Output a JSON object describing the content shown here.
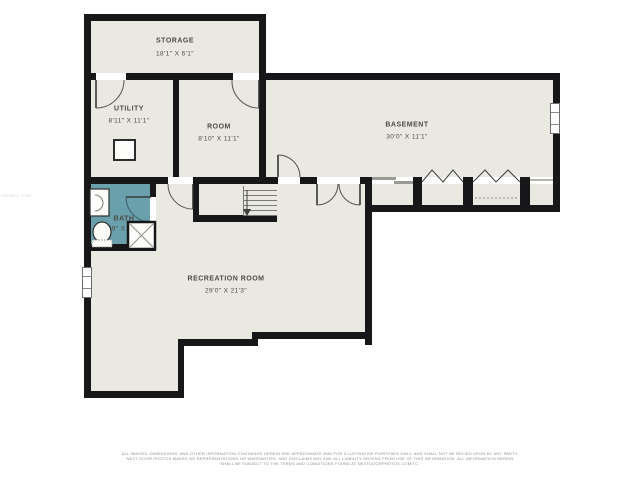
{
  "plan": {
    "title": "Basement floor plan",
    "rooms": [
      {
        "name": "STORAGE",
        "dims": "18'1\" X 6'1\""
      },
      {
        "name": "UTILITY",
        "dims": "8'11\" X 11'1\""
      },
      {
        "name": "ROOM",
        "dims": "8'10\" X 11'1\""
      },
      {
        "name": "BASEMENT",
        "dims": "30'0\" X 11'1\""
      },
      {
        "name": "BATH",
        "dims": "6'9\" X 5'2\""
      },
      {
        "name": "RECREATION ROOM",
        "dims": "29'0\" X 21'3\""
      }
    ],
    "colors": {
      "background": "#ffffff",
      "floor": "#e9e8e1",
      "wall": "#17171a",
      "bath_fill": "#6aa0ac",
      "label_text": "#4c4b45"
    },
    "symbols": [
      "door-arc",
      "double-door",
      "bifold-door",
      "sliding-door",
      "window",
      "stairs",
      "stairs-direction-arrow",
      "sink",
      "toilet",
      "shower",
      "utility-equipment",
      "closet-shelf-dashed"
    ]
  },
  "footer": {
    "line1": "ALL IMAGES, DIMENSIONS, AND OTHER INFORMATION CONTAINED HEREIN ARE APPROXIMATE AND FOR ILLUSTRATIVE PURPOSES ONLY, AND SHALL NOT BE RELIED UPON BY ANY PARTY.",
    "line2": "NEXT DOOR PHOTOS MAKES NO REPRESENTATIONS OR WARRANTIES, AND DISCLAIMS ANY AND ALL LIABILITY ARISING FROM USE OF THIS INFORMATION. ALL INFORMATION HEREIN",
    "line3": "SHALL BE SUBJECT TO THE TERMS AND CONDITIONS FOUND AT NEXTDOORPHOTOS.COM/TC."
  },
  "watermark": "DERWLL FO82"
}
